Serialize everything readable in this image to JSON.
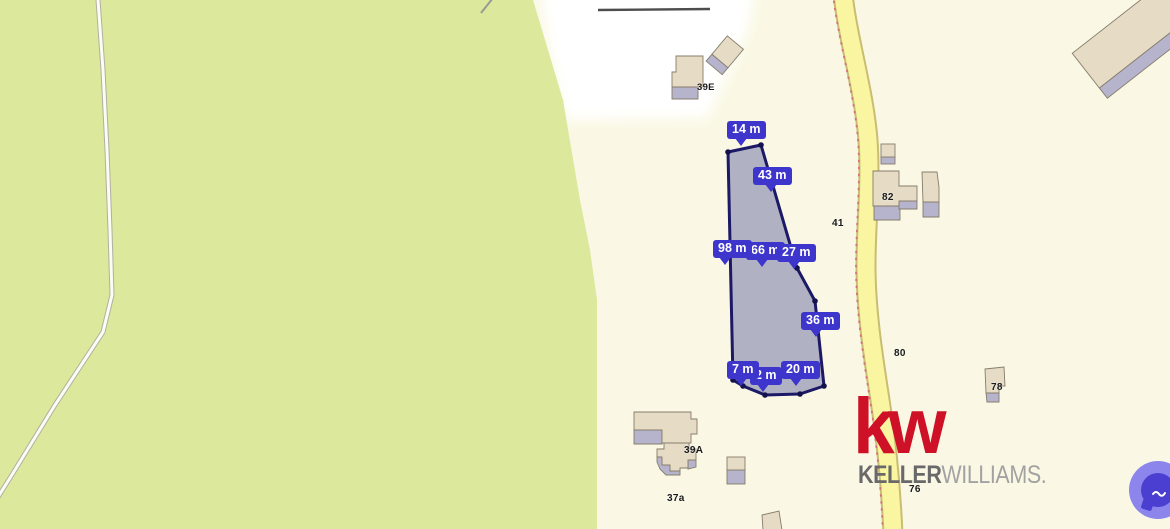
{
  "map": {
    "house_labels": {
      "l39e": "39E",
      "l82": "82",
      "l41": "41",
      "l80": "80",
      "l78": "78",
      "l39a": "39A",
      "l37a": "37a",
      "l76": "76"
    },
    "colors": {
      "forest": "#dce89b",
      "field": "#faf8e4",
      "clearing": "#ffffff",
      "road_fill": "#f9f5a1",
      "road_edge": "#c9bd72",
      "boundary_dots": "#d4737f",
      "building_top": "#e6dcc5",
      "building_side": "#b6b3cd",
      "building_outline": "#857c6b"
    }
  },
  "parcel": {
    "outline_color": "#1c1966",
    "fill_color": "#a9abc0",
    "label_bg": "#3d35cc",
    "measurements": [
      {
        "text": "14 m"
      },
      {
        "text": "43 m"
      },
      {
        "text": "98 m"
      },
      {
        "text": "66 m"
      },
      {
        "text": "27 m"
      },
      {
        "text": "36 m"
      },
      {
        "text": "7 m"
      },
      {
        "text": "2 m"
      },
      {
        "text": "20 m"
      }
    ]
  },
  "branding": {
    "mark": "kw",
    "name_left": "KELLER",
    "name_right": "WILLIAMS",
    "suffix": ".",
    "mark_color": "#ce1126"
  },
  "chat": {
    "outer_color": "#8b85ec",
    "inner_color": "#4a3fd1"
  }
}
